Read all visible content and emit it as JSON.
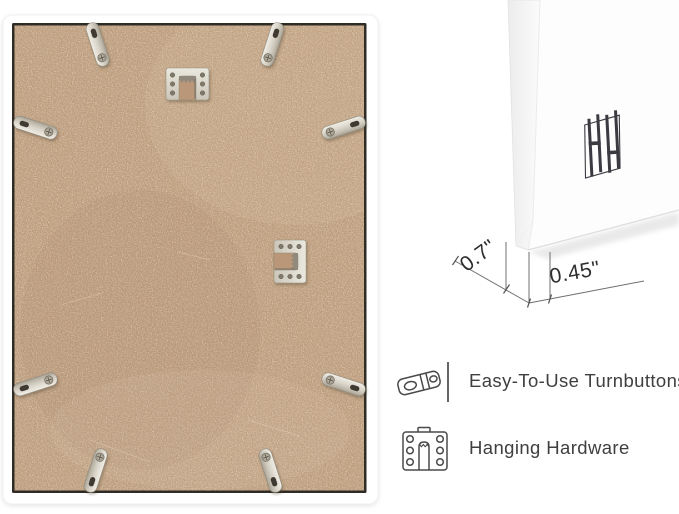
{
  "page": {
    "background": "#ffffff"
  },
  "back_photo": {
    "frame_color": "#ffffff",
    "liner_color": "#2f2c26",
    "board_color": "#c2a181",
    "metal_color": "#d9d5ca",
    "turnbutton_count": 8,
    "sawtooth_hanger_count": 2
  },
  "corner_photo": {
    "frame_color": "#fdfdfd",
    "logo_icon": "hh-monogram-logo"
  },
  "dimensions": {
    "depth_label": "0.7\"",
    "face_label": "0.45\"",
    "line_color": "#6f6f6f",
    "text_color": "#2e2e2e"
  },
  "features": [
    {
      "icon": "turnbutton-icon",
      "label": "Easy-To-Use Turnbuttons"
    },
    {
      "icon": "sawtooth-hanger-icon",
      "label": "Hanging Hardware"
    }
  ],
  "feature_text_color": "#3f3f3f",
  "icon_outline_color": "#4a4a4a"
}
